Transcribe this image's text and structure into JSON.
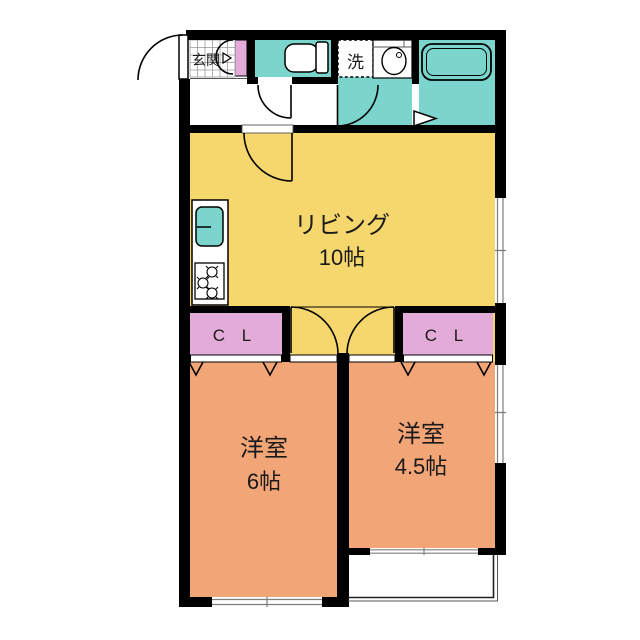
{
  "plan": {
    "type": "apartment-floor-plan",
    "rooms": {
      "living": {
        "name": "リビング",
        "size": "10帖"
      },
      "bedroom_left": {
        "name": "洋室",
        "size": "6帖"
      },
      "bedroom_right": {
        "name": "洋室",
        "size": "4.5帖"
      },
      "entrance": {
        "name": "玄関"
      },
      "laundry": {
        "name": "洗"
      },
      "closet_left": {
        "name": "C L"
      },
      "closet_right": {
        "name": "C L"
      }
    },
    "colors": {
      "living": "#F6D76E",
      "bedroom": "#F2A577",
      "wet": "#7BD5CC",
      "closet": "#E3ABD8",
      "wall": "#000000"
    }
  }
}
